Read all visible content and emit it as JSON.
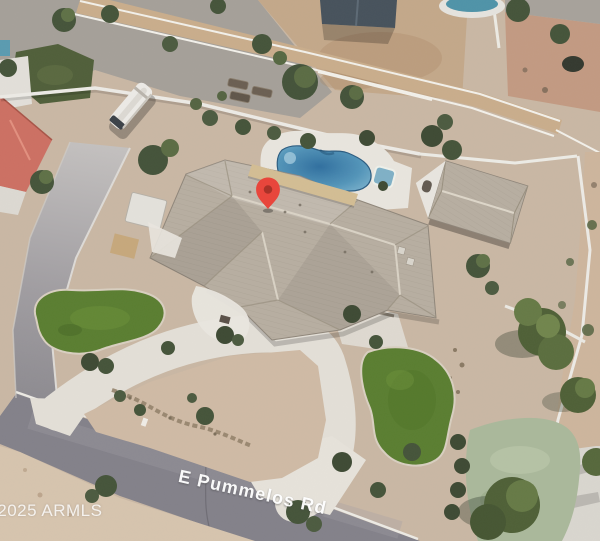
{
  "overlays": {
    "watermark": "© 2025 ARMLS",
    "street_label": "E Pummelos Rd"
  },
  "pin": {
    "icon": "map-pin-icon"
  },
  "colors": {
    "desert": "#c9b7a4",
    "gravel": "#a5a099",
    "arena": "#c3a88a",
    "arena_pink": "#c29a82",
    "path_tan": "#c9ad8c",
    "road": "#83818a",
    "driveway": "#e3dfd7",
    "lawn": "#5a7e31",
    "lawn_pale": "#aab89b",
    "pool_deep": "#2e6d9c",
    "roof": "#b7aea1",
    "patio_tan": "#d3bd94",
    "neighbor_roof_red": "#cc7063",
    "wall_white": "#eceae5",
    "tree": "#45543a",
    "pin_red": "#e8463c",
    "pin_inner": "#a93228"
  }
}
